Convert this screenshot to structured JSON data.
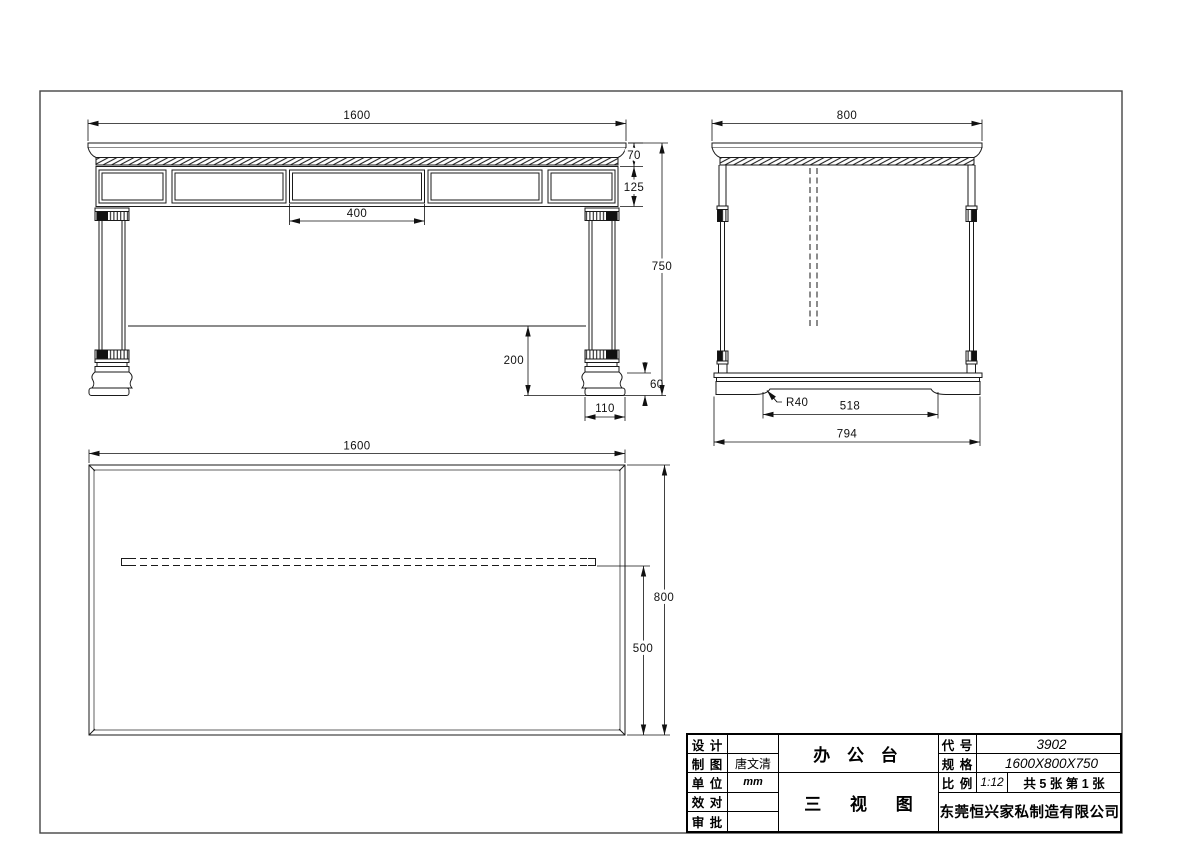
{
  "page": {
    "type": "CAD three-view furniture drawing",
    "background": "#ffffff",
    "line_color": "#1a1a1a",
    "frame_color": "#444444"
  },
  "drawing": {
    "front_view": {
      "name": "front elevation",
      "dims": {
        "width": "1600",
        "top_thickness": "70",
        "apron_height": "125",
        "center_panel": "400",
        "overall_height": "750",
        "panel_clearance": "200",
        "foot_height": "60",
        "foot_width": "110"
      }
    },
    "side_view": {
      "name": "side elevation",
      "dims": {
        "depth": "800",
        "corner_radius": "R40",
        "base_notch": "518",
        "base_width": "794"
      }
    },
    "plan_view": {
      "name": "top plan view",
      "dims": {
        "width": "1600",
        "depth": "800",
        "panel_offset": "500"
      }
    }
  },
  "title_block": {
    "fields": [
      {
        "label": "设 计",
        "value": ""
      },
      {
        "label": "制 图",
        "value": "唐文清"
      },
      {
        "label": "单 位",
        "value": "mm"
      },
      {
        "label": "效 对",
        "value": ""
      },
      {
        "label": "审 批",
        "value": ""
      }
    ],
    "product_name": "办 公 台",
    "drawing_title": "三 视 图",
    "code_label": "代 号",
    "code_value": "3902",
    "spec_label": "规 格",
    "spec_value": "1600X800X750",
    "scale_label": "比 例",
    "scale_value": "1:12",
    "sheet_info": "共 5 张 第 1 张",
    "company": "东莞恒兴家私制造有限公司"
  }
}
